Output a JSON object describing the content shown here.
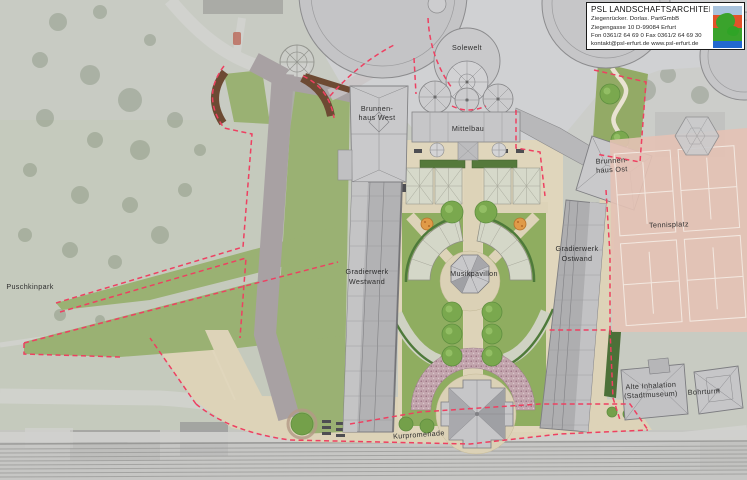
{
  "document": {
    "kind": "landscape-architecture-site-plan"
  },
  "title_block": {
    "firm": "PSL LANDSCHAFTSARCHITEKTEN",
    "partners": "Ziegenrücker. Dorlas. PartGmbB",
    "address": "Ziegengasse 10  D-99084 Erfurt",
    "phone": "Fon 0361/2 64 69 0   Fax 0361/2 64 69 30",
    "contact": "kontakt@psl-erfurt.de   www.psl-erfurt.de"
  },
  "labels": {
    "solewelt": "Solewelt",
    "brunnenhaus_west_line1": "Brunnen-",
    "brunnenhaus_west_line2": "haus West",
    "mittelbau": "Mittelbau",
    "brunnenhaus_ost_line1": "Brunnen-",
    "brunnenhaus_ost_line2": "haus Ost",
    "tennisplatz": "Tennisplatz",
    "gradierwerk_westwand_line1": "Gradierwerk",
    "gradierwerk_westwand_line2": "Westwand",
    "gradierwerk_ostwand_line1": "Gradierwerk",
    "gradierwerk_ostwand_line2": "Ostwand",
    "musikpavillon": "Musikpavillon",
    "puschkinpark": "Puschkinpark",
    "alte_inhalation_line1": "Alte Inhalation",
    "alte_inhalation_line2": "(Stadtmuseum)",
    "bohrturm": "Bohrturm",
    "kurpromenade": "Kurpromenade"
  },
  "colors": {
    "boundary_dashed": "#ee4061",
    "lawn": "#9ab173",
    "garden_lawn": "#8fad60",
    "path_beige": "#ddd3b8",
    "building_fill": "#c6c6c8",
    "building_stroke": "#7e7e82",
    "roof_shade": "#a2a2a6",
    "hedge_brown": "#6d4a33",
    "hedge_dark_green": "#4c7038",
    "tennis_court": "#e4c2b5",
    "tennis_lines": "#f6efe8",
    "tree_green": "#7aa84e",
    "rose_bed": "#c3a6ae",
    "aerial_base": "#c8cbc2",
    "logo_blue_light": "#a9c3dd",
    "logo_orange": "#e2522a",
    "logo_green": "#3aa32c",
    "logo_blue": "#2268cf"
  }
}
